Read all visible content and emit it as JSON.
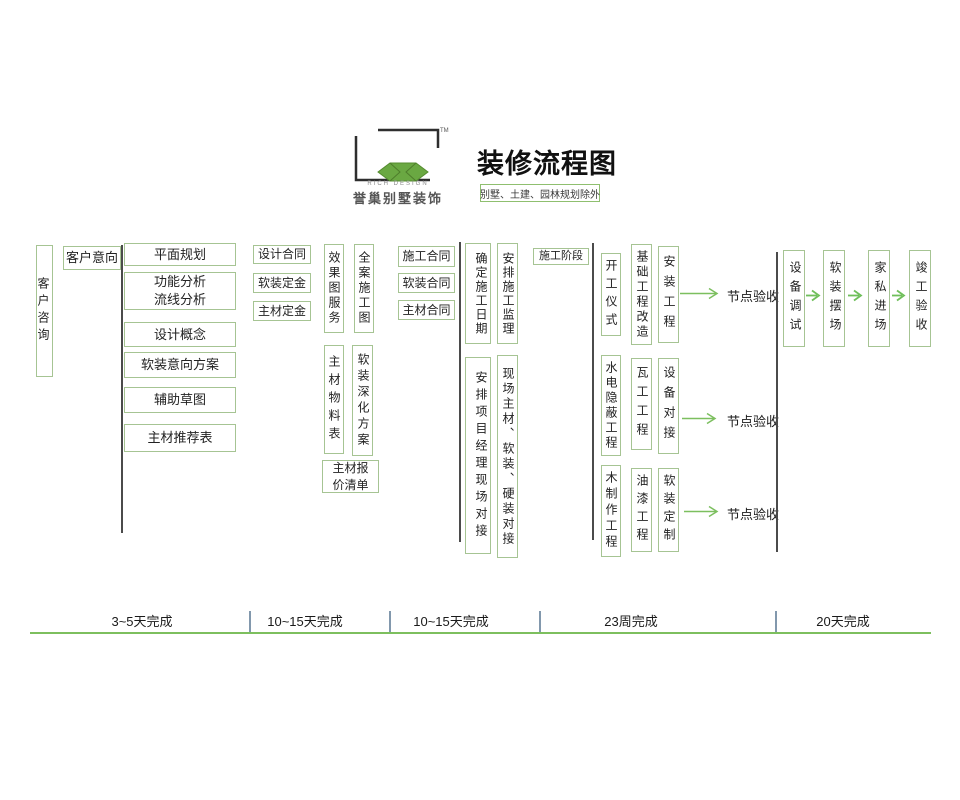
{
  "header": {
    "brand_en": "RICH DESIGN",
    "brand_cn": "誉巢别墅装饰",
    "tm": "TM",
    "title": "装修流程图",
    "subtitle": "别墅、土建、园林规划除外"
  },
  "flow": {
    "consult": "客户咨询",
    "intent": "客户意向",
    "design_steps": [
      "平面规划",
      "功能分析\n流线分析",
      "设计概念",
      "软装意向方案",
      "辅助草图",
      "主材推荐表"
    ],
    "design_contracts": [
      "设计合同",
      "软装定金",
      "主材定金"
    ],
    "deepen_top": [
      "效果图服务",
      "全案施工图"
    ],
    "deepen_bottom": [
      "主材物料表",
      "软装深化方案"
    ],
    "quote": "主材报\n价清单",
    "build_contracts": [
      "施工合同",
      "软装合同",
      "主材合同"
    ],
    "prep_top": [
      "确定施工日期",
      "安排施工监理"
    ],
    "prep_bottom": [
      "安排项目经理现场对接",
      "现场主材、软装、硬装对接"
    ],
    "stage_label": "施工阶段",
    "construction": [
      [
        "开工仪式",
        "基础工程改造",
        "安装工程"
      ],
      [
        "水电隐蔽工程",
        "瓦工工程",
        "设备对接"
      ],
      [
        "木制作工程",
        "油漆工程",
        "软装定制"
      ]
    ],
    "node_accept": [
      "节点验收",
      "节点验收",
      "节点验收"
    ],
    "final_steps": [
      "设备调试",
      "软装摆场",
      "家私进场",
      "竣工验收"
    ]
  },
  "timeline": {
    "segments": [
      "3~5天完成",
      "10~15天完成",
      "10~15天完成",
      "23周完成",
      "20天完成"
    ]
  },
  "colors": {
    "box_border": "#a6c493",
    "arrow_green": "#7cbf5f",
    "line_dark": "#4b4b4b",
    "tick_blue": "#8298ad",
    "logo_green": "#6aa842"
  }
}
